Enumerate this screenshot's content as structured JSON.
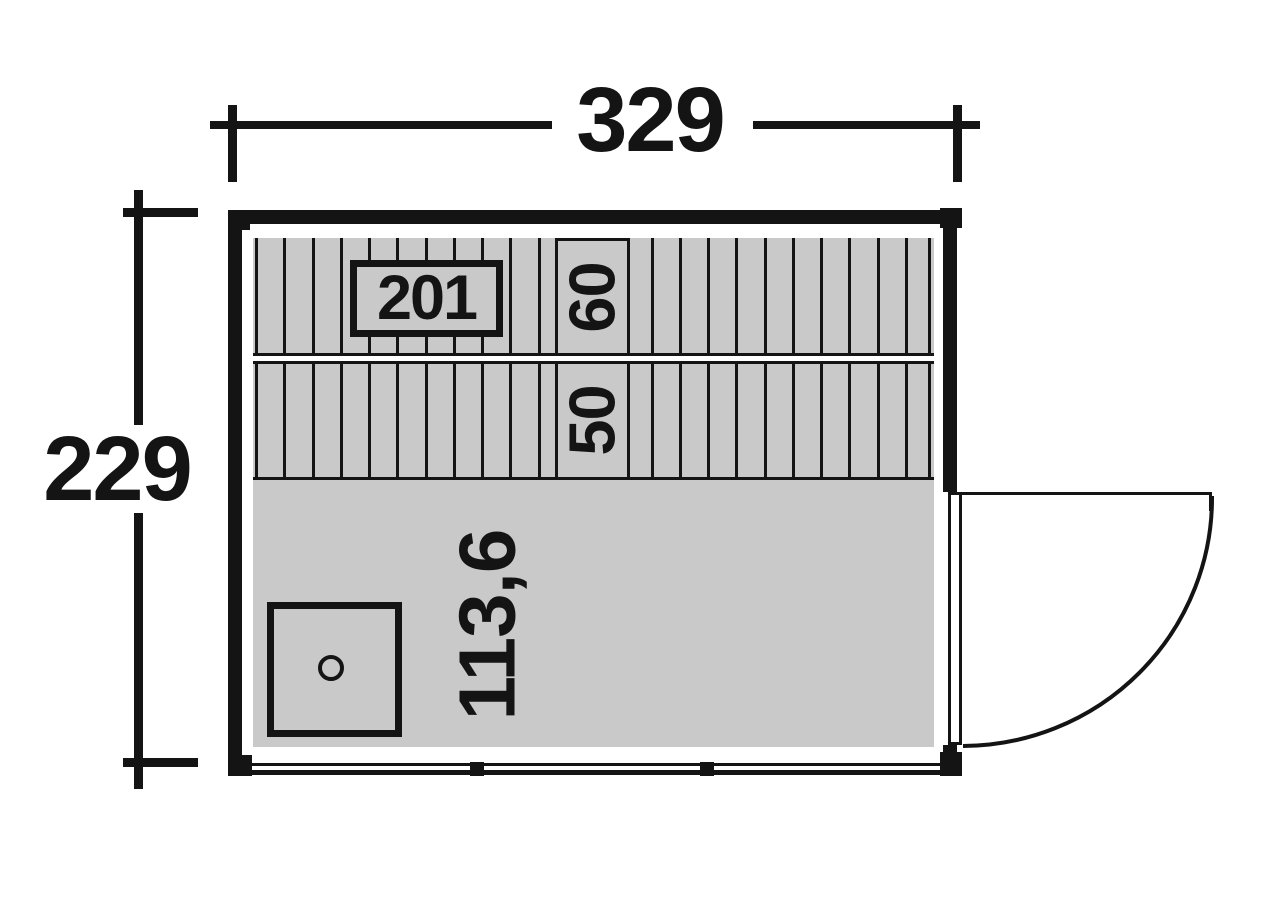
{
  "dimensions": {
    "overall_width": "329",
    "overall_depth": "229",
    "bench_length": "201",
    "bench_upper_depth": "60",
    "bench_lower_depth": "50",
    "floor_depth": "113,6"
  },
  "colors": {
    "surface_gray": "#c9c9c9",
    "line_black": "#141414",
    "background": "#ffffff"
  },
  "elements": {
    "stove_icon": "stove-square-with-vent-circle",
    "door_icon": "right-side-door-swing-arc"
  }
}
